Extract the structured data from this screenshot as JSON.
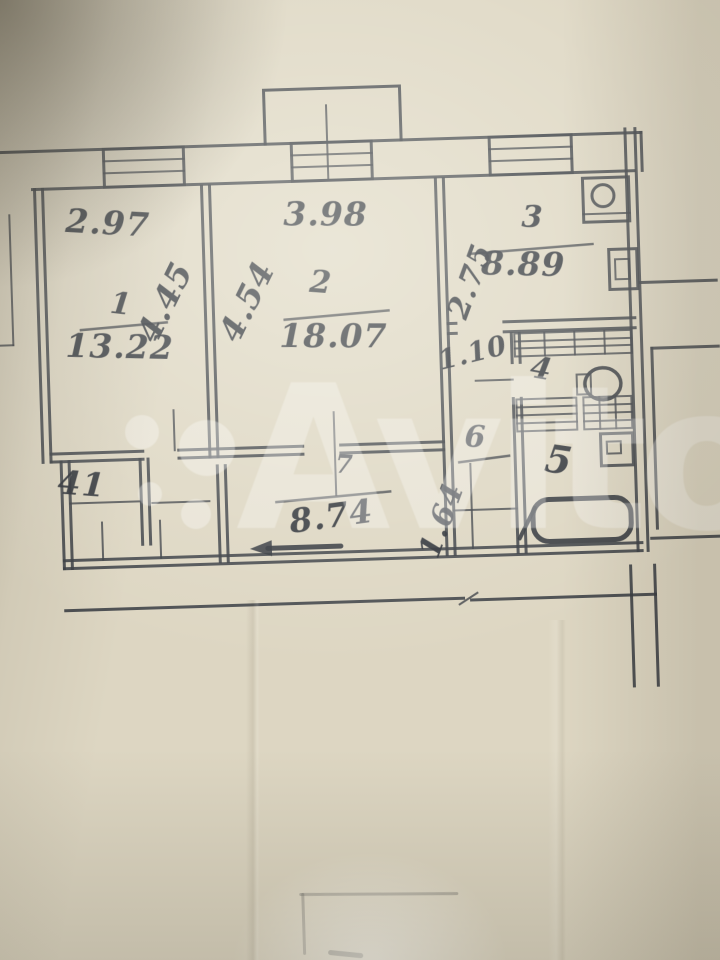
{
  "watermark": {
    "brand": "Avito"
  },
  "floor_plan": {
    "room_numbers": {
      "living1": "1",
      "living2": "2",
      "kitchen": "3",
      "toilet": "4",
      "bathroom": "5",
      "closet": "6",
      "corridor": "7",
      "storage": "41"
    },
    "room_areas": {
      "living1": "13.22",
      "living2": "18.07",
      "kitchen": "8.89",
      "corridor": "8.74"
    },
    "dimensions": {
      "living1_width": "2.97",
      "living1_depth": "4.45",
      "living2_width": "3.98",
      "living2_depth": "4.54",
      "kitchen_depth": "2.75",
      "hall_width": "1.10",
      "corridor_width": "1.64"
    }
  },
  "fixtures": {
    "stove": "stove-icon",
    "kitchen_sink": "sink-icon",
    "toilet": "toilet-icon",
    "bathtub": "bathtub-icon",
    "entrance": "entrance-arrow-icon"
  },
  "colors": {
    "paper": "#ddd6c2",
    "ink": "#383c42",
    "watermark": "rgba(255,255,255,0.30)"
  }
}
